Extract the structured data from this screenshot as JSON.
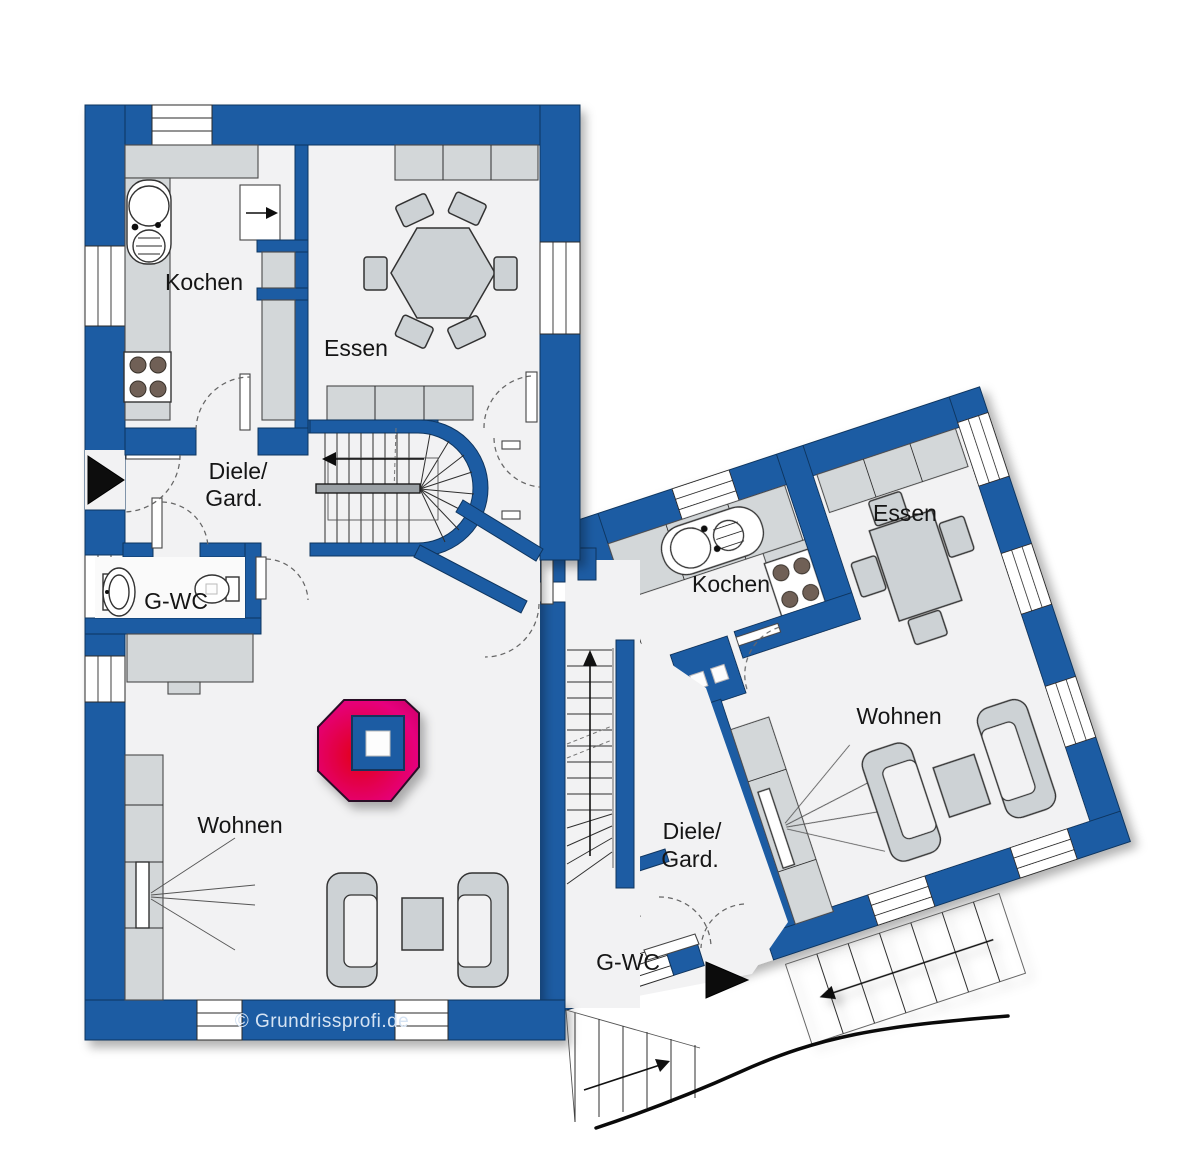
{
  "plan_type": "floor-plan",
  "units": {
    "left": {
      "kitchen": "Kochen",
      "dining": "Essen",
      "hallway_line1": "Diele/",
      "hallway_line2": "Gard.",
      "guest_wc": "G-WC",
      "living": "Wohnen"
    },
    "right": {
      "kitchen": "Kochen",
      "dining": "Essen",
      "hallway_line1": "Diele/",
      "hallway_line2": "Gard.",
      "guest_wc": "G-WC",
      "living": "Wohnen"
    }
  },
  "footer": {
    "copyright": "© Grundrissprofi.de"
  },
  "colors": {
    "wall": "#1d5ca3",
    "floor": "#f2f2f3",
    "counter": "#d3d7d9",
    "furniture": "#cdd2d5",
    "logo_pink": "#e6007d",
    "logo_red": "#e30613",
    "copyright_text": "#d5e3f3"
  }
}
